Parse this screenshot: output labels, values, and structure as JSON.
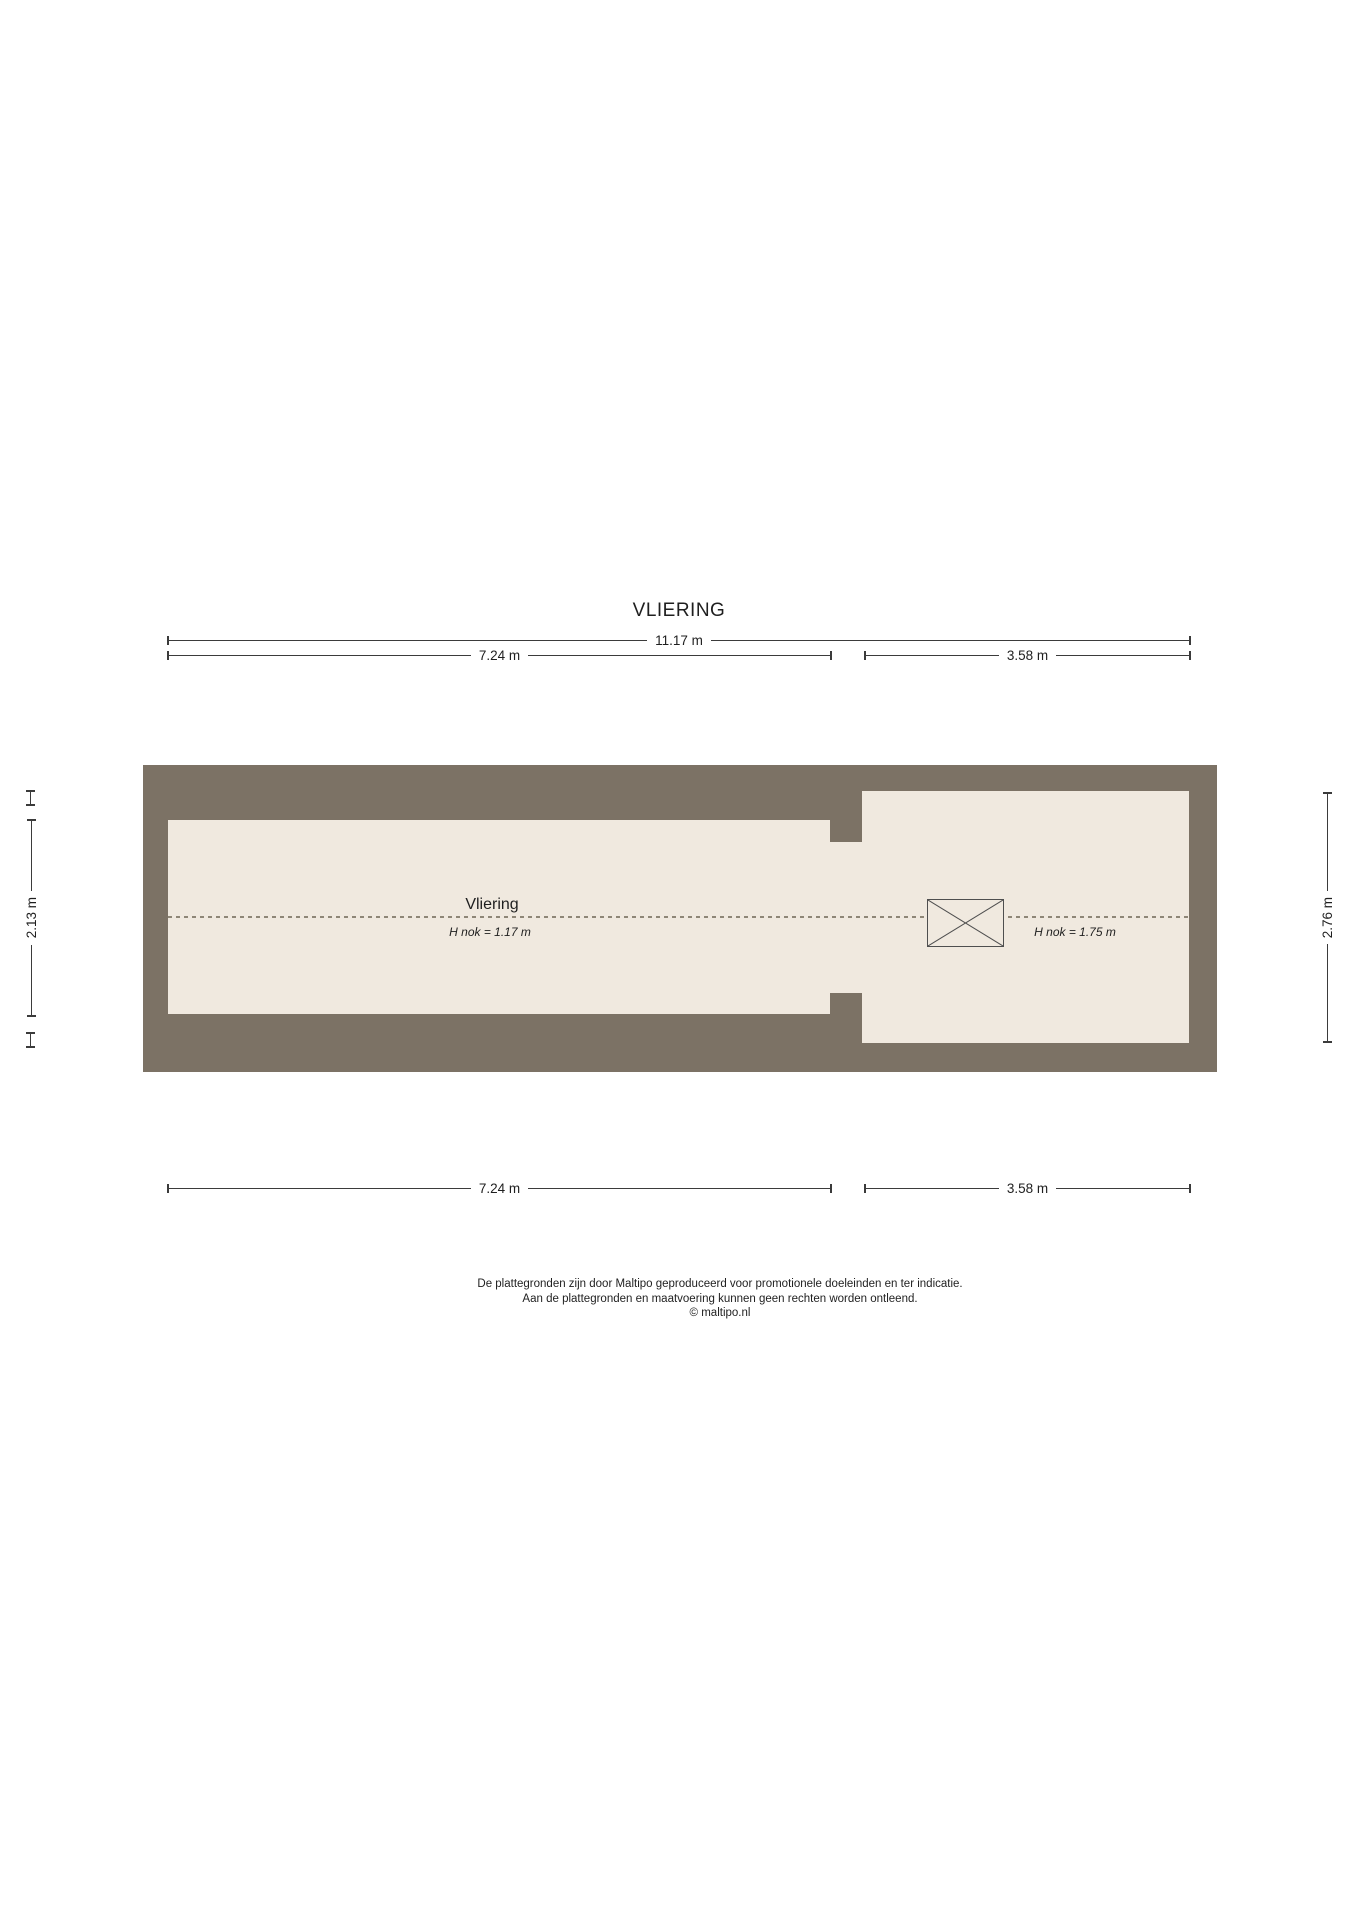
{
  "title": "VLIERING",
  "colors": {
    "wall": "#7c7265",
    "floor": "#f0e9df",
    "line": "#3b3b3b",
    "dotted": "#8e8677",
    "text": "#1f1f1f",
    "background": "#ffffff"
  },
  "dimensions": {
    "top_total": "11.17 m",
    "top_left": "7.24 m",
    "top_right": "3.58 m",
    "bottom_left": "7.24 m",
    "bottom_right": "3.58 m",
    "side_left": "2.13 m",
    "side_right": "2.76 m"
  },
  "rooms": {
    "main_label": "Vliering",
    "main_ridge_height": "H nok = 1.17 m",
    "right_ridge_height": "H nok = 1.75 m"
  },
  "footer": {
    "line1": "De plattegronden zijn door Maltipo geproduceerd voor promotionele doeleinden en ter indicatie.",
    "line2": "Aan de plattegronden en maatvoering kunnen geen rechten worden ontleend.",
    "line3": "© maltipo.nl"
  }
}
